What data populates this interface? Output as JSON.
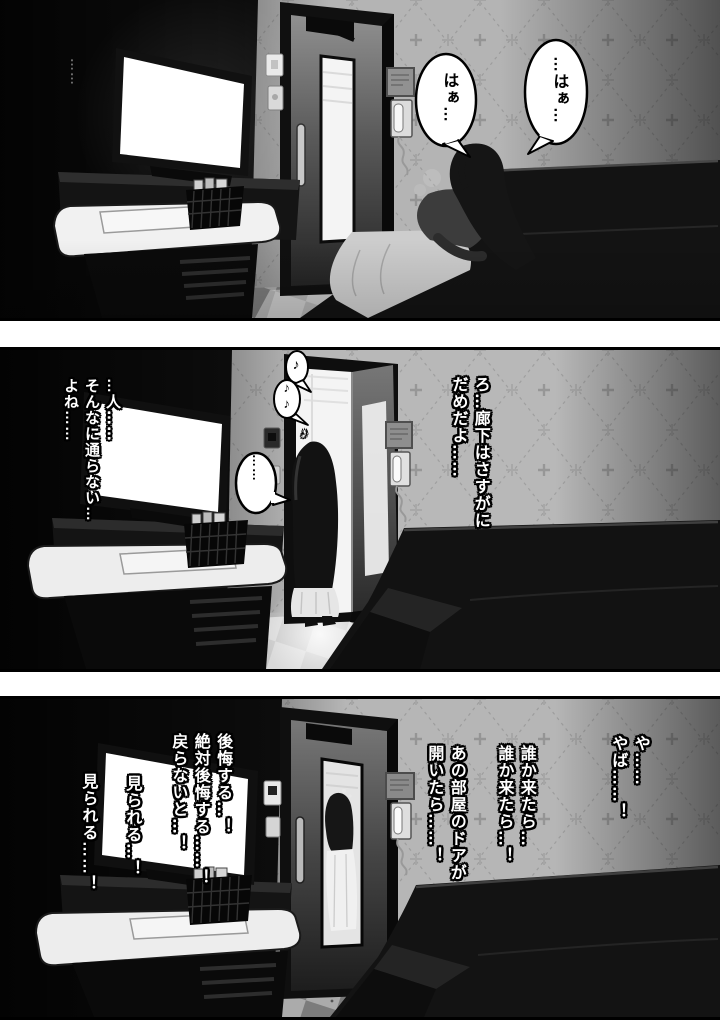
{
  "page": {
    "background": "#ffffff",
    "ink": "#000000"
  },
  "panel1": {
    "bubble_right_text": "…はぁ…",
    "bubble_left_text": "はぁ…",
    "wall_ellipsis": "……"
  },
  "panel2": {
    "dialogue_right": "ろ…廊下はさすがに\nだめだよ……",
    "monologue_left": "…人……\nそんなに通らない…\nよね……",
    "bubble_ellipsis": "……",
    "music_note_top": "♪",
    "music_notes_bottom": "♪♪",
    "music_note_stray": "♪"
  },
  "panel3": {
    "exclaim_right": "や……\nやば……！",
    "worry_someone": "誰か来たら…\n誰か来たら…！",
    "worry_door": "あの部屋のドアが\n開いたら……！",
    "regret": "後悔する…！\n絶対後悔する……！\n戻らないと…！",
    "seen_short": "見られる…！",
    "seen_long": "見られる……！"
  }
}
